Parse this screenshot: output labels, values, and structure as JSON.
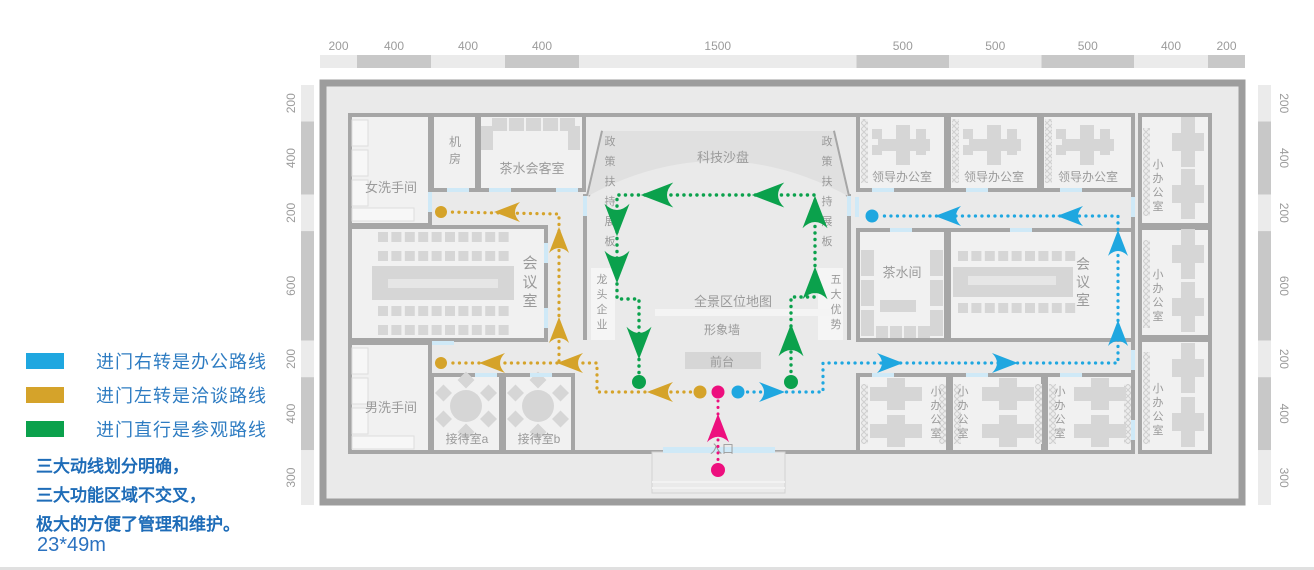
{
  "legend": {
    "items": [
      {
        "id": "office-route",
        "color": "#1FA7E0",
        "label": "进门右转是办公路线"
      },
      {
        "id": "talk-route",
        "color": "#D5A32A",
        "label": "进门左转是洽谈路线"
      },
      {
        "id": "visit-route",
        "color": "#0BA14C",
        "label": "进门直行是参观路线"
      }
    ],
    "text_color": "#2E7CC2"
  },
  "notes": [
    "三大动线划分明确，",
    "三大功能区域不交叉，",
    "极大的方便了管理和维护。"
  ],
  "notes_color": "#1E6CB8",
  "dimensions_label": "23*49m",
  "dimensions_color": "#2B72C0",
  "plan": {
    "colors": {
      "wall": "#9d9d9d",
      "wall2": "#a6a6a6",
      "interior": "#eaeaea",
      "room": "#f1f1f1",
      "furn": "#d6d6d6",
      "furn_light": "#f4f4f4",
      "slab": "#e0e0e0",
      "partition": "#f5f5f5",
      "ruler_dark": "#c8c8c8",
      "ruler_light": "#ebebeb",
      "ruler_text": "#9b9b9b",
      "label": "#9a9a9a",
      "door": "#cfe9f7",
      "hatch": "#dadada",
      "blue": "#1FA7E0",
      "yellow": "#D5A32A",
      "green": "#0BA14C",
      "pink": "#ED0F7E"
    },
    "rulers": {
      "top": {
        "values": [
          200,
          400,
          400,
          400,
          1500,
          500,
          500,
          500,
          400,
          200
        ],
        "x0": 320,
        "x1": 1245,
        "y": 55,
        "h": 13,
        "label_y": 50
      },
      "left": {
        "values": [
          200,
          400,
          200,
          600,
          200,
          400,
          300
        ],
        "y0": 85,
        "y1": 505,
        "x": 301,
        "w": 13,
        "label_x": 291
      },
      "right": {
        "values": [
          200,
          400,
          200,
          600,
          200,
          400,
          300
        ],
        "y0": 85,
        "y1": 505,
        "x": 1258,
        "w": 13,
        "label_x": 1284
      }
    },
    "building": {
      "x": 323,
      "y": 83,
      "w": 919,
      "h": 419
    },
    "walls": [
      [
        350,
        115,
        1133,
        115
      ],
      [
        350,
        452,
        663,
        452
      ],
      [
        775,
        452,
        1133,
        452
      ],
      [
        350,
        115,
        350,
        452
      ],
      [
        1133,
        115,
        1133,
        452
      ],
      [
        585,
        194,
        585,
        340
      ],
      [
        849,
        194,
        849,
        340
      ],
      [
        603,
        131,
        588,
        196
      ],
      [
        833,
        131,
        848,
        196
      ]
    ],
    "rooms": [
      {
        "id": "women-restroom",
        "label": "女洗手间",
        "x": 350,
        "y": 115,
        "w": 80,
        "h": 110,
        "lx": 391,
        "ly": 192,
        "size": 13
      },
      {
        "id": "machine-room",
        "label": "机房",
        "x": 432,
        "y": 115,
        "w": 45,
        "h": 75,
        "lx": 455,
        "ly": 146,
        "size": 12,
        "vertical": true,
        "step": 17
      },
      {
        "id": "tea-guest-room",
        "label": "茶水会客室",
        "x": 479,
        "y": 115,
        "w": 105,
        "h": 75,
        "lx": 532,
        "ly": 173,
        "size": 13
      },
      {
        "id": "meeting-room-left",
        "label": "会议室",
        "x": 350,
        "y": 227,
        "w": 196,
        "h": 113,
        "lx": 530,
        "ly": 268,
        "size": 15,
        "vertical": true,
        "step": 19
      },
      {
        "id": "men-restroom",
        "label": "男洗手间",
        "x": 350,
        "y": 343,
        "w": 80,
        "h": 109,
        "lx": 391,
        "ly": 412,
        "size": 13
      },
      {
        "id": "reception-a",
        "label": "接待室a",
        "x": 432,
        "y": 375,
        "w": 69,
        "h": 77,
        "lx": 467,
        "ly": 443,
        "size": 12
      },
      {
        "id": "reception-b",
        "label": "接待室b",
        "x": 504,
        "y": 375,
        "w": 69,
        "h": 77,
        "lx": 539,
        "ly": 443,
        "size": 12
      },
      {
        "id": "leader-office-1",
        "label": "领导办公室",
        "x": 858,
        "y": 115,
        "w": 88,
        "h": 75,
        "lx": 902,
        "ly": 181,
        "size": 12
      },
      {
        "id": "leader-office-2",
        "label": "领导办公室",
        "x": 949,
        "y": 115,
        "w": 90,
        "h": 75,
        "lx": 994,
        "ly": 181,
        "size": 12
      },
      {
        "id": "leader-office-3",
        "label": "领导办公室",
        "x": 1042,
        "y": 115,
        "w": 91,
        "h": 75,
        "lx": 1088,
        "ly": 181,
        "size": 12
      },
      {
        "id": "tea-room",
        "label": "茶水间",
        "x": 858,
        "y": 230,
        "w": 88,
        "h": 110,
        "lx": 902,
        "ly": 277,
        "size": 13
      },
      {
        "id": "meeting-room-right",
        "label": "会议室",
        "x": 949,
        "y": 230,
        "w": 184,
        "h": 110,
        "lx": 1083,
        "ly": 269,
        "size": 14,
        "vertical": true,
        "step": 18
      },
      {
        "id": "small-office-1",
        "label": "小办公室",
        "x": 858,
        "y": 375,
        "w": 90,
        "h": 77,
        "lx": 936,
        "ly": 395,
        "size": 11,
        "vertical": true,
        "step": 14
      },
      {
        "id": "small-office-2",
        "label": "小办公室",
        "x": 951,
        "y": 375,
        "w": 92,
        "h": 77,
        "lx": 963,
        "ly": 395,
        "size": 11,
        "vertical": true,
        "step": 14
      },
      {
        "id": "small-office-3",
        "label": "小办公室",
        "x": 1046,
        "y": 375,
        "w": 87,
        "h": 77,
        "lx": 1060,
        "ly": 395,
        "size": 11,
        "vertical": true,
        "step": 14
      },
      {
        "id": "small-office-4",
        "label": "小办公室",
        "x": 1140,
        "y": 115,
        "w": 70,
        "h": 110,
        "lx": 1158,
        "ly": 168,
        "size": 11,
        "vertical": true,
        "step": 14
      },
      {
        "id": "small-office-5",
        "label": "小办公室",
        "x": 1140,
        "y": 228,
        "w": 70,
        "h": 109,
        "lx": 1158,
        "ly": 278,
        "size": 11,
        "vertical": true,
        "step": 14
      },
      {
        "id": "small-office-6",
        "label": "小办公室",
        "x": 1140,
        "y": 340,
        "w": 70,
        "h": 112,
        "lx": 1158,
        "ly": 392,
        "size": 11,
        "vertical": true,
        "step": 14
      }
    ],
    "slab": {
      "path": "M603,131 L833,131 L848,196 Q718,126 588,196 Z"
    },
    "special_rects": [
      {
        "id": "partition-left",
        "x": 591,
        "y": 268,
        "w": 24,
        "h": 72,
        "fill": "partition"
      },
      {
        "id": "partition-right",
        "x": 818,
        "y": 268,
        "w": 25,
        "h": 72,
        "fill": "partition"
      },
      {
        "id": "image-wall-slab",
        "x": 655,
        "y": 309,
        "w": 178,
        "h": 7,
        "fill": "furn_light"
      },
      {
        "id": "front-desk-counter",
        "x": 685,
        "y": 352,
        "w": 76,
        "h": 17,
        "fill": "furn"
      },
      {
        "id": "entrance-vestibule",
        "x": 652,
        "y": 452,
        "w": 133,
        "h": 41,
        "fill": "interior",
        "stroke": "#d2d2d2"
      }
    ],
    "vestibule_lines": [
      [
        652,
        482,
        785,
        482
      ],
      [
        652,
        488,
        785,
        488
      ]
    ],
    "entrance_door": {
      "x": 663,
      "y": 447,
      "w": 112,
      "h": 6
    },
    "free_labels": [
      {
        "id": "tech-sandbox",
        "text": "科技沙盘",
        "x": 723,
        "y": 162,
        "size": 13
      },
      {
        "id": "policy-board-left",
        "text": "政策扶持展板",
        "x": 610,
        "y": 145,
        "size": 11,
        "vertical": true,
        "step": 20
      },
      {
        "id": "policy-board-right",
        "text": "政策扶持展板",
        "x": 827,
        "y": 145,
        "size": 11,
        "vertical": true,
        "step": 20
      },
      {
        "id": "dragon-enterprise",
        "text": "龙头企业",
        "x": 602,
        "y": 283,
        "size": 11,
        "vertical": true,
        "step": 15
      },
      {
        "id": "five-advantages",
        "text": "五大优势",
        "x": 836,
        "y": 283,
        "size": 11,
        "vertical": true,
        "step": 15
      },
      {
        "id": "panorama-map",
        "text": "全景区位地图",
        "x": 733,
        "y": 306,
        "size": 13
      },
      {
        "id": "image-wall",
        "text": "形象墙",
        "x": 722,
        "y": 334,
        "size": 12
      },
      {
        "id": "front-desk",
        "text": "前台",
        "x": 722,
        "y": 366,
        "size": 12
      },
      {
        "id": "entrance",
        "text": "入口",
        "x": 722,
        "y": 453,
        "size": 12
      }
    ],
    "hatches": [
      [
        861,
        119,
        7,
        64
      ],
      [
        952,
        119,
        7,
        64
      ],
      [
        1045,
        119,
        7,
        64
      ],
      [
        1143,
        128,
        7,
        88
      ],
      [
        1143,
        240,
        7,
        88
      ],
      [
        1143,
        352,
        7,
        92
      ],
      [
        861,
        384,
        7,
        60
      ],
      [
        939,
        384,
        7,
        60
      ],
      [
        954,
        384,
        7,
        60
      ],
      [
        1035,
        384,
        7,
        60
      ],
      [
        1049,
        384,
        7,
        60
      ],
      [
        1124,
        384,
        7,
        60
      ]
    ],
    "furniture": {
      "chair_rows": [
        {
          "x": 378,
          "y": 232,
          "n": 10
        },
        {
          "x": 378,
          "y": 251,
          "n": 10
        },
        {
          "x": 378,
          "y": 306,
          "n": 10
        },
        {
          "x": 378,
          "y": 325,
          "n": 10
        },
        {
          "x": 958,
          "y": 251,
          "n": 9
        },
        {
          "x": 958,
          "y": 303,
          "n": 9
        },
        {
          "x": 876,
          "y": 326,
          "n": 4,
          "pitch": 14,
          "w": 12,
          "h": 12
        }
      ],
      "tables": [
        {
          "x": 372,
          "y": 266,
          "w": 142,
          "h": 34,
          "stripe": [
            388,
            279,
            110,
            9
          ]
        },
        {
          "x": 953,
          "y": 267,
          "w": 120,
          "h": 30,
          "stripe": [
            968,
            276,
            88,
            9
          ]
        }
      ],
      "round_tables": [
        {
          "cx": 466,
          "cy": 406
        },
        {
          "cx": 538,
          "cy": 406
        }
      ],
      "sofas": [
        [
          492,
          118,
          15,
          13
        ],
        [
          509,
          118,
          15,
          13
        ],
        [
          526,
          118,
          15,
          13
        ],
        [
          543,
          118,
          15,
          13
        ],
        [
          560,
          118,
          15,
          13
        ],
        [
          481,
          126,
          12,
          24
        ],
        [
          568,
          126,
          12,
          24
        ],
        [
          861,
          250,
          13,
          26
        ],
        [
          861,
          280,
          13,
          26
        ],
        [
          861,
          310,
          13,
          26
        ],
        [
          930,
          250,
          13,
          26
        ],
        [
          930,
          280,
          13,
          26
        ],
        [
          930,
          310,
          13,
          26
        ],
        [
          880,
          300,
          36,
          12
        ]
      ],
      "restroom_fixtures": [
        [
          352,
          120,
          16,
          26
        ],
        [
          352,
          150,
          16,
          26
        ],
        [
          352,
          180,
          16,
          26
        ],
        [
          352,
          208,
          62,
          13
        ],
        [
          352,
          348,
          16,
          26
        ],
        [
          352,
          378,
          16,
          26
        ],
        [
          352,
          408,
          16,
          26
        ],
        [
          352,
          436,
          62,
          13
        ]
      ],
      "leader_desks": [
        {
          "x": 858,
          "y": 115
        },
        {
          "x": 949,
          "y": 115
        },
        {
          "x": 1042,
          "y": 115
        }
      ],
      "cross_desks_h": [
        {
          "cx": 896,
          "cy": 394
        },
        {
          "cx": 896,
          "cy": 431
        },
        {
          "cx": 1008,
          "cy": 394
        },
        {
          "cx": 1008,
          "cy": 431
        },
        {
          "cx": 1100,
          "cy": 394
        },
        {
          "cx": 1100,
          "cy": 431
        }
      ],
      "cross_desks_v": [
        {
          "cx": 1188,
          "cy": 142
        },
        {
          "cx": 1188,
          "cy": 194
        },
        {
          "cx": 1188,
          "cy": 254
        },
        {
          "cx": 1188,
          "cy": 307
        },
        {
          "cx": 1188,
          "cy": 368
        },
        {
          "cx": 1188,
          "cy": 422
        }
      ]
    },
    "doors_h": [
      [
        447,
        188
      ],
      [
        489,
        188
      ],
      [
        556,
        188
      ],
      [
        872,
        188
      ],
      [
        966,
        188
      ],
      [
        1060,
        188
      ],
      [
        872,
        373
      ],
      [
        966,
        373
      ],
      [
        1060,
        373
      ],
      [
        432,
        341
      ],
      [
        475,
        373
      ],
      [
        530,
        373
      ],
      [
        890,
        228
      ],
      [
        1010,
        228
      ]
    ],
    "doors_v": [
      [
        583,
        196
      ],
      [
        847,
        196
      ],
      [
        1131,
        197
      ],
      [
        1131,
        350
      ],
      [
        544,
        243
      ],
      [
        544,
        308
      ],
      [
        855,
        197
      ],
      [
        428,
        192
      ],
      [
        1131,
        420
      ]
    ],
    "routes": [
      {
        "id": "visit-route",
        "color": "green",
        "width": 3.4,
        "arrow_scale": 1.25,
        "polylines": [
          [
            [
              791,
              378
            ],
            [
              791,
              297
            ],
            [
              815,
              297
            ],
            [
              815,
              195
            ],
            [
              617,
              195
            ],
            [
              617,
              299
            ],
            [
              639,
              299
            ],
            [
              639,
              378
            ]
          ]
        ],
        "dots": [
          [
            791,
            382,
            7
          ],
          [
            639,
            382,
            7
          ]
        ],
        "arrows": [
          [
            791,
            340,
            "up"
          ],
          [
            815,
            283,
            "up"
          ],
          [
            815,
            212,
            "up"
          ],
          [
            768,
            195,
            "left"
          ],
          [
            657,
            195,
            "left"
          ],
          [
            617,
            220,
            "down"
          ],
          [
            617,
            267,
            "down"
          ],
          [
            639,
            343,
            "down"
          ]
        ]
      },
      {
        "id": "talk-route",
        "color": "yellow",
        "width": 3.2,
        "arrow_scale": 1.0,
        "polylines": [
          [
            [
              697,
              392
            ],
            [
              597,
              392
            ],
            [
              597,
              363
            ],
            [
              447,
              363
            ]
          ],
          [
            [
              559,
              361
            ],
            [
              559,
              214
            ],
            [
              447,
              212
            ]
          ]
        ],
        "dots": [
          [
            700,
            392,
            6.5
          ],
          [
            441,
            363,
            6
          ],
          [
            441,
            212,
            6
          ]
        ],
        "arrows": [
          [
            660,
            392,
            "left"
          ],
          [
            570,
            363,
            "left"
          ],
          [
            492,
            363,
            "left"
          ],
          [
            559,
            330,
            "up"
          ],
          [
            559,
            240,
            "up"
          ],
          [
            507,
            212,
            "left"
          ]
        ]
      },
      {
        "id": "office-route",
        "color": "blue",
        "width": 3.2,
        "arrow_scale": 1.0,
        "polylines": [
          [
            [
              741,
              392
            ],
            [
              823,
              392
            ],
            [
              823,
              363
            ],
            [
              1118,
              363
            ],
            [
              1118,
              216
            ],
            [
              878,
              216
            ]
          ]
        ],
        "dots": [
          [
            738,
            392,
            6.5
          ],
          [
            872,
            216,
            6.5
          ]
        ],
        "arrows": [
          [
            772,
            392,
            "right"
          ],
          [
            890,
            363,
            "right"
          ],
          [
            1005,
            363,
            "right"
          ],
          [
            1118,
            333,
            "up"
          ],
          [
            1118,
            243,
            "up"
          ],
          [
            1070,
            216,
            "left"
          ],
          [
            948,
            216,
            "left"
          ]
        ]
      },
      {
        "id": "entry-route",
        "color": "pink",
        "width": 3.0,
        "arrow_scale": 1.1,
        "polylines": [
          [
            [
              718,
              466
            ],
            [
              718,
              398
            ]
          ]
        ],
        "dots": [
          [
            718,
            470,
            7
          ],
          [
            718,
            392,
            6.5
          ]
        ],
        "arrows": [
          [
            718,
            428,
            "up"
          ]
        ]
      }
    ]
  }
}
